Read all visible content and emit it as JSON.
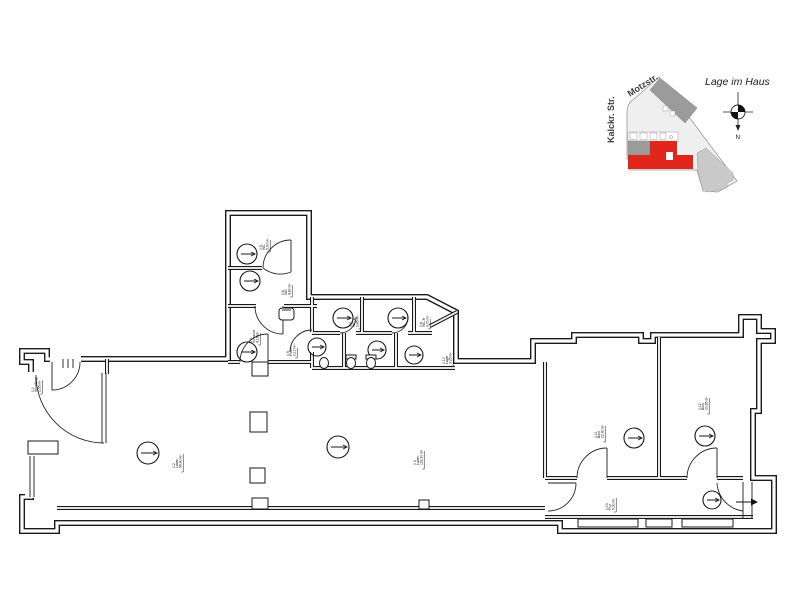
{
  "site_plan": {
    "title": "Lage im Haus",
    "street_diagonal": "Motzstr.",
    "street_vertical": "Kalckr. Str.",
    "compass_label": "N",
    "colors": {
      "unit_red": "#e2261b",
      "building_dark": "#9b9b9b",
      "building_light": "#c9c9c9",
      "parcel_fill": "#efefef",
      "outline_gray": "#9a9a9a"
    }
  },
  "floor_plan": {
    "wall_color": "#1a1a1a",
    "stamps": [
      {
        "id": "vestibule",
        "lines": [
          "0.1",
          "Windfang",
          "2,95 m²"
        ]
      },
      {
        "id": "hall-left",
        "lines": [
          "0.2",
          "Laden",
          "96,40 m²"
        ]
      },
      {
        "id": "hall-center",
        "lines": [
          "0.3",
          "Laden",
          "118,30 m²"
        ]
      },
      {
        "id": "anteroom",
        "lines": [
          "0.4",
          "Vorraum",
          "4,15 m²"
        ]
      },
      {
        "id": "wc-upper",
        "lines": [
          "0.5",
          "WC",
          "5,60 m²"
        ]
      },
      {
        "id": "wc-lower",
        "lines": [
          "0.6",
          "WC",
          "4,80 m²"
        ]
      },
      {
        "id": "wc-cubicle-a",
        "lines": [
          "0.7",
          "WC-D",
          "3,85 m²"
        ]
      },
      {
        "id": "wc-cubicle-b",
        "lines": [
          "0.8",
          "WC-H",
          "3,70 m²"
        ]
      },
      {
        "id": "wc-cubicle-c",
        "lines": [
          "0.9",
          "Putzr.",
          "2,10 m²"
        ]
      },
      {
        "id": "store",
        "lines": [
          "0.10",
          "Lager",
          "3,25 m²"
        ]
      },
      {
        "id": "office-1",
        "lines": [
          "0.11",
          "Büro",
          "22,40 m²"
        ]
      },
      {
        "id": "office-2",
        "lines": [
          "0.12",
          "Büro",
          "20,85 m²"
        ]
      },
      {
        "id": "corridor",
        "lines": [
          "0.13",
          "Flur",
          "9,30 m²"
        ]
      }
    ]
  }
}
